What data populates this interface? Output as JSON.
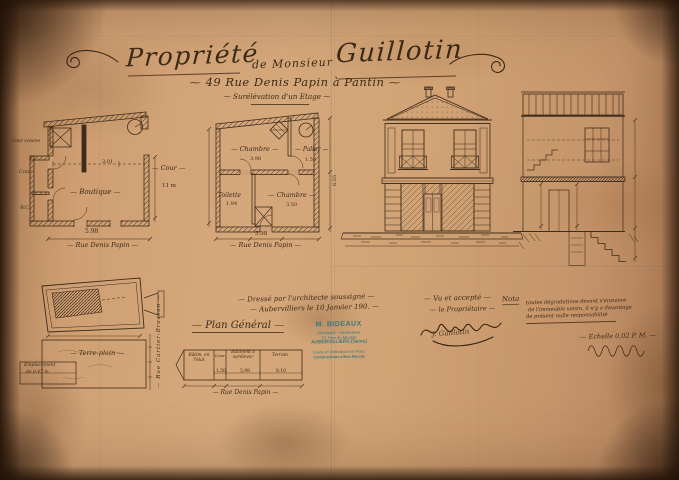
{
  "colors": {
    "paper": "#cfa176",
    "ink": "#3e2c1b",
    "stamp": "#2e7d84"
  },
  "title": {
    "word1": "Propriété",
    "connector": "de Monsieur",
    "word2": "Guillotin",
    "address": "49 Rue Denis Papin à Pantin",
    "subtitle": "Surélévation d'un Etage"
  },
  "ground_plan": {
    "label_cour_voisine": "Cour voisine",
    "label_cour": "Cour",
    "label_wc": "W.C.",
    "label_room": "Boutique",
    "dim_interior": "3.01",
    "dim_bottom": "5.98",
    "label_cour_right": "Cour",
    "dim_cour_right": "11 m",
    "street": "Rue Denis Papin"
  },
  "first_plan": {
    "room_top_left": "Chambre",
    "dim_top_left": "3.98",
    "room_top_right": "Palier",
    "dim_top_right": "1.50",
    "room_bottom_left": "Toilette",
    "dim_bottom_left": "1.94",
    "room_bottom_right": "Chambre",
    "dim_bottom_right": "3.50",
    "dim_right": "6.55",
    "dim_bottom": "5.98",
    "street": "Rue Denis Papin"
  },
  "attic_block": {
    "terrain_label": "Terre-plein",
    "side_street": "Rue Cartier-Bresson",
    "corner_line1": "Emplacement",
    "corner_line2": "de 0,47 m"
  },
  "plan_general": {
    "title": "Plan Général",
    "comp1": "Bâtim. en l'état",
    "comp2": "Cour",
    "comp3": "Bâtiment à surélever",
    "comp4": "Terrain",
    "dim2": "1.50",
    "dim3": "5.98",
    "dim4": "8.10",
    "street": "Rue Denis Papin"
  },
  "certification": {
    "line1": "Dressé par l'architecte soussigné",
    "line2": "Aubervilliers le 10 Janvier 190."
  },
  "stamp": {
    "name": "M. BIDEAUX",
    "role": "Architecte - Vérificateur",
    "address": "13, Rue du Moutier",
    "city": "AUBERVILLIERS (Seine)",
    "line5": "Levés et Vérifications de Plans",
    "line6": "Constructions à Bon Marché"
  },
  "approval": {
    "line1": "Vu et accepté",
    "line2": "le Propriétaire",
    "signature": "J. Guillotin"
  },
  "nota": {
    "label": "Nota",
    "line1": "toutes dégradations devant s'ensuivre",
    "line2": "de l'immeuble voisin, il n'y a davantage",
    "line3": "de présent nulle responsabilité",
    "scale": "Echelle 0,02 P. M."
  }
}
